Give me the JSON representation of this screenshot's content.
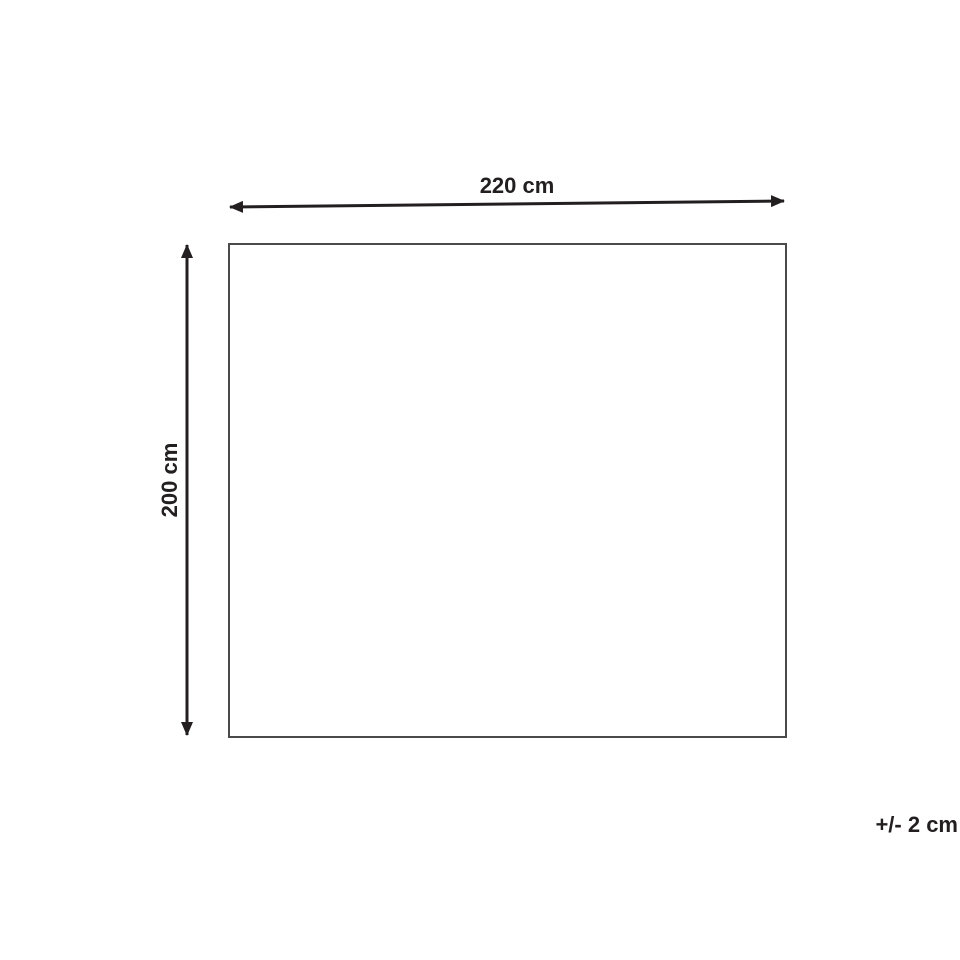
{
  "diagram": {
    "type": "dimension-diagram",
    "shape": "rectangle",
    "dimensions": {
      "width": {
        "value": 220,
        "unit": "cm",
        "label": "220 cm"
      },
      "height": {
        "value": 200,
        "unit": "cm",
        "label": "200 cm"
      },
      "tolerance": {
        "value": 2,
        "unit": "cm",
        "label": "+/- 2 cm"
      }
    }
  },
  "colors": {
    "background": "#ffffff",
    "arrow": "#231f20",
    "label_text": "#231f20",
    "rectangle_border": "#4a4a4a"
  }
}
